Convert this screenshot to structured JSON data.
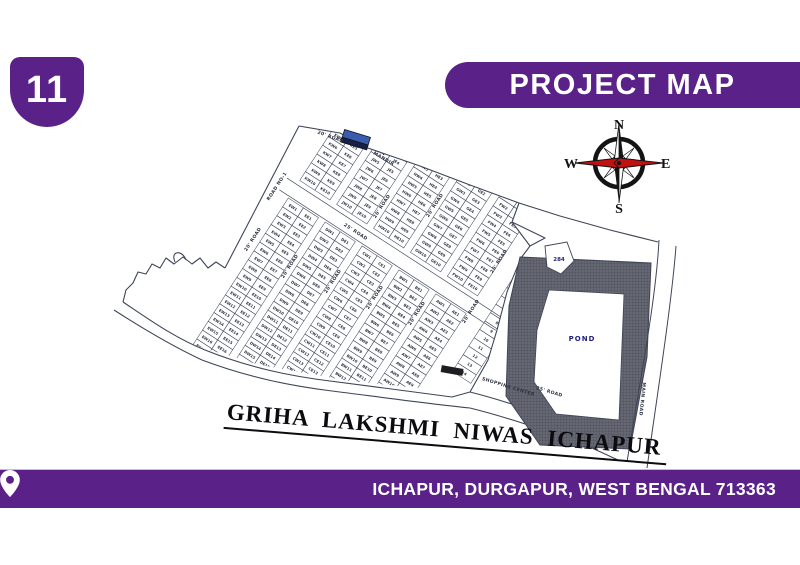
{
  "badge": {
    "number": "11"
  },
  "header": {
    "title": "PROJECT MAP"
  },
  "footer": {
    "location": "ICHAPUR, DURGAPUR, WEST BENGAL 713363"
  },
  "accent_color": "#5a2189",
  "compass": {
    "north": "N",
    "east": "E",
    "south": "S",
    "west": "W",
    "needle_color": "#c11212"
  },
  "map": {
    "title": "GRIHA LAKSHMI NIWAS ICHAPUR",
    "pond_label": "POND",
    "plot_284_label": "284",
    "landmark_label": "MANDIR",
    "road_names": [
      "20' ROAD",
      "25' ROAD",
      "MAIN ROAD",
      "SHOPPING CENTER",
      "ROAD NO-1"
    ],
    "strips": {
      "upper": [
        {
          "west": "KW",
          "east": "KE"
        },
        {
          "west": "JW",
          "east": "JE"
        },
        {
          "west": "HW",
          "east": "HE"
        },
        {
          "west": "GW",
          "east": "GE"
        },
        {
          "west": "FW",
          "east": "FE"
        }
      ],
      "lower": [
        {
          "west": "EW",
          "east": "EE"
        },
        {
          "west": "DW",
          "east": "DE"
        },
        {
          "west": "CW",
          "east": "CE"
        },
        {
          "west": "BW",
          "east": "BE"
        },
        {
          "west": "AW",
          "east": "AE"
        }
      ],
      "numbered_strip_count": 14
    }
  }
}
